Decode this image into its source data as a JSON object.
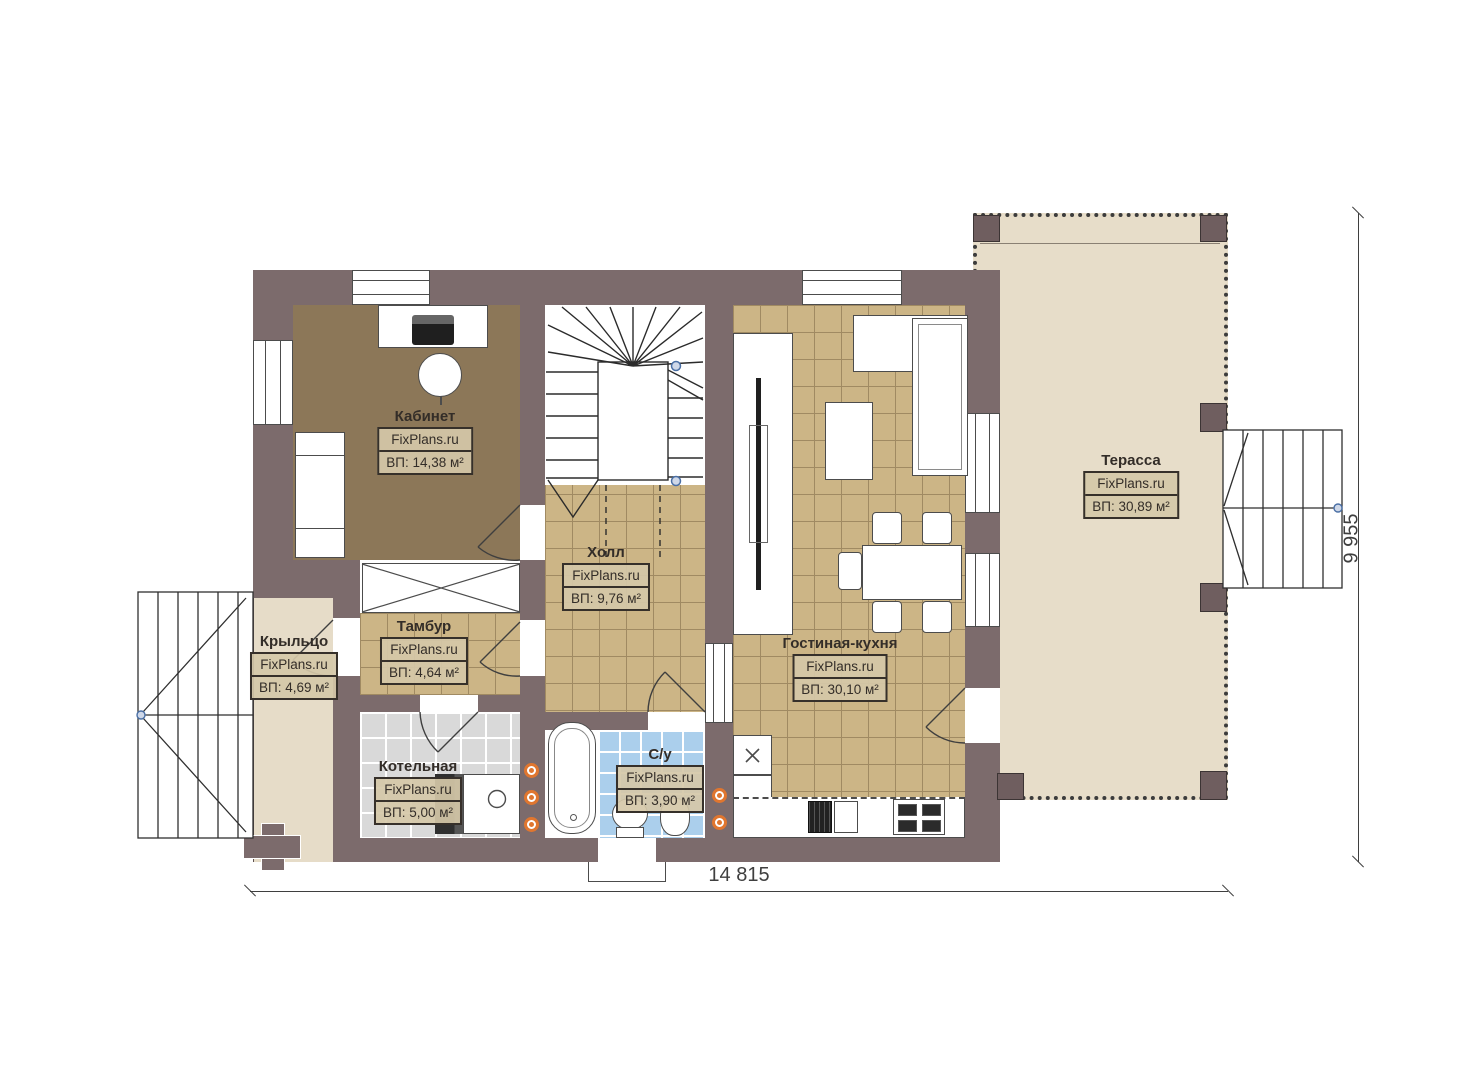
{
  "watermark": "FixPlans.ru",
  "rooms": [
    {
      "name": "Кабинет",
      "area": "ВП: 14,38 м²"
    },
    {
      "name": "Холл",
      "area": "ВП: 9,76 м²"
    },
    {
      "name": "Тамбур",
      "area": "ВП: 4,64 м²"
    },
    {
      "name": "Котельная",
      "area": "ВП: 5,00 м²"
    },
    {
      "name": "С/у",
      "area": "ВП: 3,90 м²"
    },
    {
      "name": "Гостиная-кухня",
      "area": "ВП: 30,10 м²"
    },
    {
      "name": "Терасса",
      "area": "ВП: 30,89 м²"
    },
    {
      "name": "Крыльцо",
      "area": "ВП: 4,69 м²"
    }
  ],
  "dimensions": {
    "width": "14 815",
    "height": "9 955"
  },
  "colors": {
    "wall": "#7c6b6c",
    "tile_floor": "#ccb586",
    "office_floor": "#8c7758",
    "boiler_floor": "#d9d9d9",
    "bath_floor": "#abcfec",
    "terrace_floor": "#e7ddc9",
    "label_bg": "#d5c8a8",
    "radiator": "#e0762f",
    "dimension_text": "#3f3f3f"
  }
}
